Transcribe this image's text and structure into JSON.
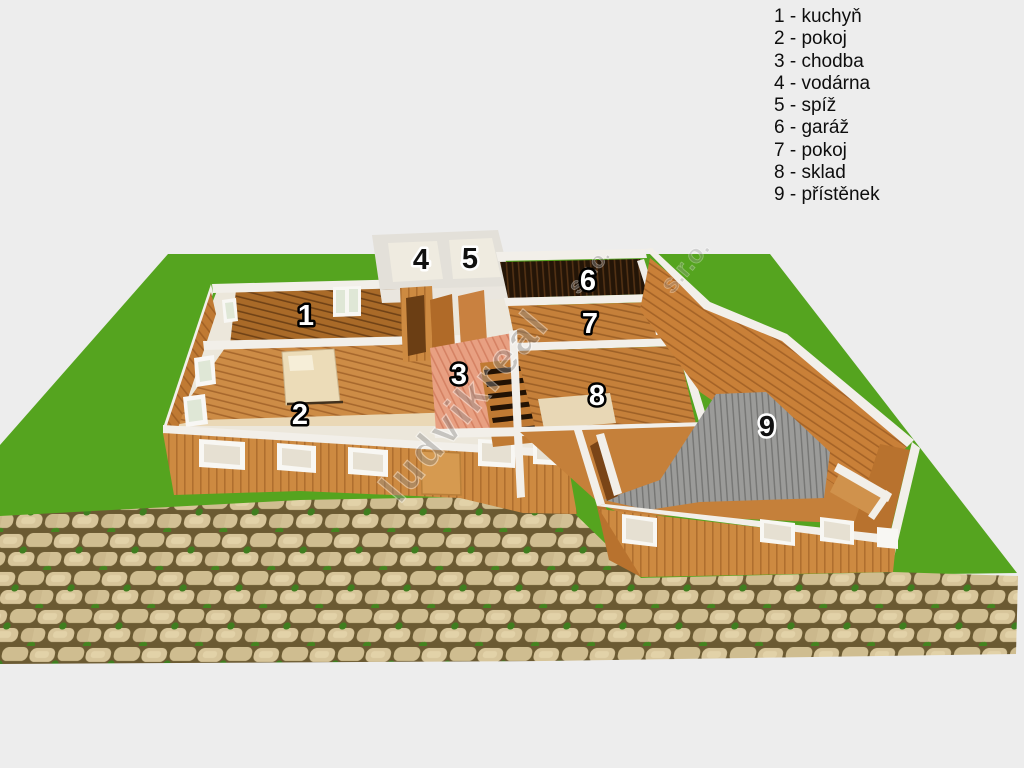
{
  "legend": {
    "items": [
      {
        "number": "1",
        "name": "kuchyň",
        "text": "1 - kuchyň"
      },
      {
        "number": "2",
        "name": "pokoj",
        "text": "2 - pokoj"
      },
      {
        "number": "3",
        "name": "chodba",
        "text": "3 - chodba"
      },
      {
        "number": "4",
        "name": "vodárna",
        "text": "4 - vodárna"
      },
      {
        "number": "5",
        "name": "spíž",
        "text": "5 - spíž"
      },
      {
        "number": "6",
        "name": "garáž",
        "text": "6 - garáž"
      },
      {
        "number": "7",
        "name": "pokoj",
        "text": "7 - pokoj"
      },
      {
        "number": "8",
        "name": "sklad",
        "text": "8 - sklad"
      },
      {
        "number": "9",
        "name": "přístěnek",
        "text": "9 - přístěnek"
      }
    ]
  },
  "rooms": [
    {
      "number": "1",
      "name": "kuchyň"
    },
    {
      "number": "2",
      "name": "pokoj"
    },
    {
      "number": "3",
      "name": "chodba"
    },
    {
      "number": "4",
      "name": "vodárna"
    },
    {
      "number": "5",
      "name": "spíž"
    },
    {
      "number": "6",
      "name": "garáž"
    },
    {
      "number": "7",
      "name": "pokoj"
    },
    {
      "number": "8",
      "name": "sklad"
    },
    {
      "number": "9",
      "name": "přístěnek"
    }
  ],
  "watermark": {
    "main": "ludvikreal",
    "suffix": "s.r.o."
  },
  "colors": {
    "background": "#ededed",
    "grass": "#55a41f",
    "wall_wood": "#c9853f",
    "wall_top_white": "#f2efe9",
    "kitchen_floor": "#a96a28",
    "hall_floor": "#e8a082",
    "garage_floor": "#241507",
    "gray_floor": "#9b9b99",
    "stone_path": "#d7c59a",
    "stone_gap": "#6b5a32",
    "bed": "#ecdcb8"
  }
}
